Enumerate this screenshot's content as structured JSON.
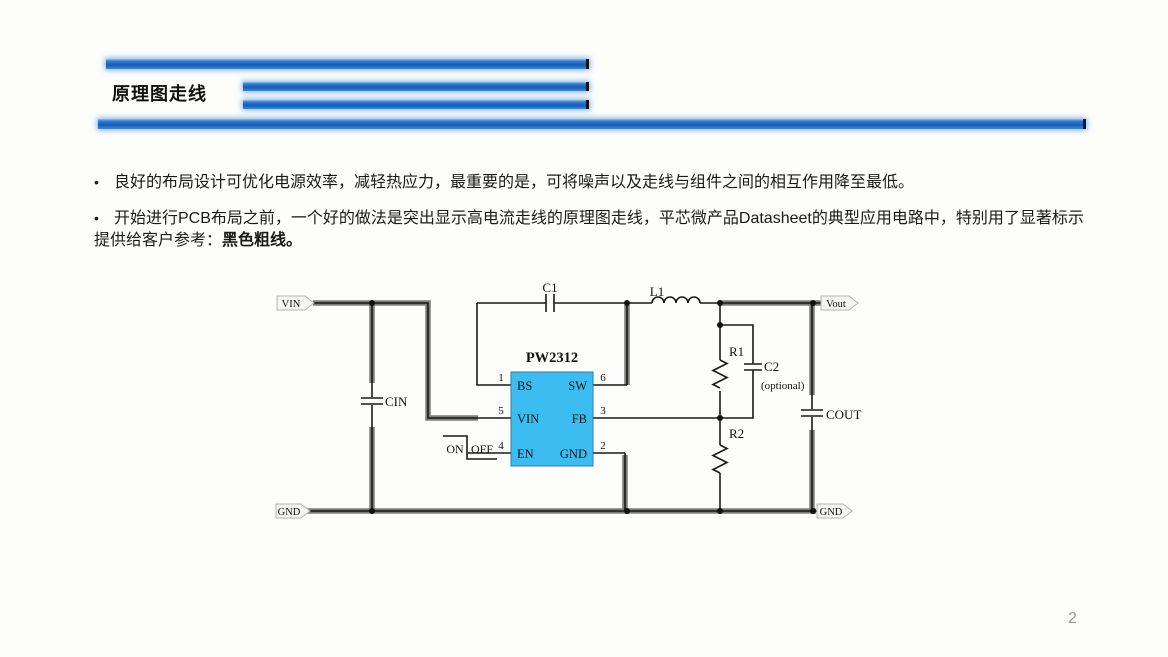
{
  "slide": {
    "title": "原理图走线",
    "page_number": "2",
    "bullets": {
      "marker": "•",
      "b1": "良好的布局设计可优化电源效率，减轻热应力，最重要的是，可将噪声以及走线与组件之间的相互作用降至最低。",
      "b2_text": "开始进行PCB布局之前，一个好的做法是突出显示高电流走线的原理图走线，平芯微产品Datasheet的典型应用电路中，特别用了显著标示提供给客户参考：",
      "b2_bold": "黑色粗线。"
    }
  },
  "circuit": {
    "ic": {
      "part": "PW2312",
      "pin_labels": {
        "bs": "BS",
        "sw": "SW",
        "vin": "VIN",
        "fb": "FB",
        "en": "EN",
        "gnd": "GND"
      },
      "pin_numbers": {
        "bs": "1",
        "sw": "6",
        "vin": "5",
        "fb": "3",
        "en": "4",
        "gnd": "2"
      }
    },
    "components": {
      "c1": "C1",
      "l1": "L1",
      "cin": "CIN",
      "cout": "COUT",
      "r1": "R1",
      "r2": "R2",
      "c2": "C2",
      "c2_note": "(optional)"
    },
    "switch": {
      "on": "ON",
      "off": "OFF"
    },
    "net_tags": {
      "vin": "VIN",
      "gnd_left": "GND",
      "vout": "Vout",
      "gnd_right": "GND"
    }
  },
  "colors": {
    "accent_bar_blue": "#1f66c2",
    "ic_fill": "#3bbdf2",
    "highlight_wire": "#7d7d7d",
    "wire": "#1a1a1a"
  }
}
